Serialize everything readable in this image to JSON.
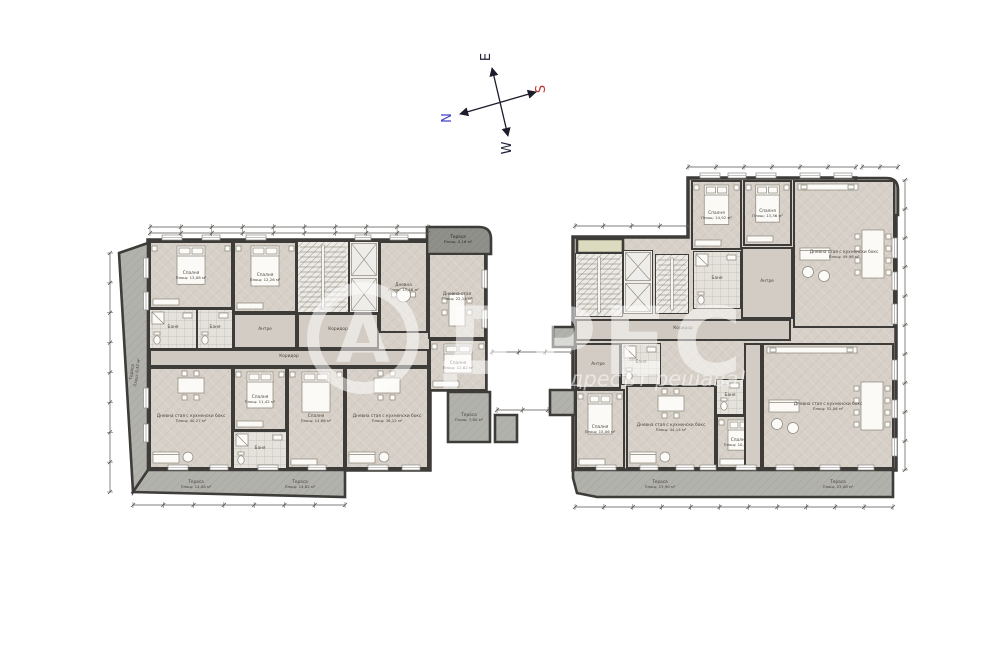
{
  "compass": {
    "n": "N",
    "s": "S",
    "e": "E",
    "w": "W"
  },
  "watermark": {
    "logo_letter": "А",
    "brand_rest": "ДРЕС",
    "slogan": "адресът решава!"
  },
  "colors": {
    "wall": "#3e3c39",
    "floor": "#d6d0c8",
    "terrace": "#b2b2ad",
    "terrace_dark": "#8f908a",
    "terrace_beige": "#dcdabf",
    "label": "#4a453e",
    "north_blue": "#4343c8",
    "south_red": "#c23230"
  },
  "left_block": {
    "rooms": [
      {
        "t": "bedroom",
        "x": 150,
        "y": 242,
        "w": 82,
        "h": 66,
        "name": "Спалня",
        "area": "Площ: 13,08 м²"
      },
      {
        "t": "bedroom",
        "x": 234,
        "y": 242,
        "w": 62,
        "h": 70,
        "name": "Спалня",
        "area": "Площ: 12,26 м²"
      },
      {
        "t": "stairs",
        "x": 298,
        "y": 242,
        "w": 50,
        "h": 70
      },
      {
        "t": "elevator",
        "x": 350,
        "y": 242,
        "w": 28,
        "h": 70
      },
      {
        "t": "living_small",
        "x": 380,
        "y": 242,
        "w": 47,
        "h": 90,
        "name": "Дневна",
        "area": "Площ: 15,48 м²"
      },
      {
        "t": "dining",
        "x": 429,
        "y": 254,
        "w": 56,
        "h": 84,
        "name": "Дневна стая",
        "area": "Площ: 22,14 м²"
      },
      {
        "t": "bath",
        "x": 150,
        "y": 310,
        "w": 46,
        "h": 38,
        "name": "Баня"
      },
      {
        "t": "bath",
        "x": 198,
        "y": 310,
        "w": 34,
        "h": 38,
        "name": "Баня"
      },
      {
        "t": "hall",
        "x": 234,
        "y": 314,
        "w": 62,
        "h": 34,
        "name": "Антре"
      },
      {
        "t": "hall",
        "x": 298,
        "y": 314,
        "w": 80,
        "h": 34,
        "name": "Коридор"
      },
      {
        "t": "corridor",
        "x": 150,
        "y": 350,
        "w": 278,
        "h": 16,
        "name": "Коридор"
      },
      {
        "t": "living_big",
        "x": 150,
        "y": 368,
        "w": 82,
        "h": 100,
        "name": "Дневна стая с кухненски бокс",
        "area": "Площ: 40,27 м²"
      },
      {
        "t": "bedroom",
        "x": 234,
        "y": 368,
        "w": 52,
        "h": 62,
        "name": "Спалня",
        "area": "Площ: 11,42 м²"
      },
      {
        "t": "bath",
        "x": 234,
        "y": 432,
        "w": 52,
        "h": 36,
        "name": "Баня"
      },
      {
        "t": "bedroom",
        "x": 288,
        "y": 368,
        "w": 56,
        "h": 100,
        "name": "Спалня",
        "area": "Площ: 14,86 м²"
      },
      {
        "t": "living_big",
        "x": 346,
        "y": 368,
        "w": 82,
        "h": 100,
        "name": "Дневна стая с кухненски бокс",
        "area": "Площ: 36,12 м²"
      },
      {
        "t": "bedroom",
        "x": 430,
        "y": 340,
        "w": 56,
        "h": 50,
        "name": "Спалня",
        "area": "Площ: 12,62 м²"
      }
    ],
    "terraces": [
      {
        "shape": [
          [
            119,
            253
          ],
          [
            148,
            243
          ],
          [
            148,
            470
          ],
          [
            133,
            492
          ]
        ],
        "kind": "gray",
        "name": "Тераса",
        "area": "Площ: 9,42 м²",
        "lx": 133,
        "ly": 372,
        "rot": -83
      },
      {
        "shape": [
          [
            148,
            470
          ],
          [
            345,
            470
          ],
          [
            345,
            497
          ],
          [
            133,
            492
          ]
        ],
        "kind": "gray",
        "name": "Тераса",
        "area": "Площ: 14,08 м²",
        "lx": 196,
        "ly": 483
      },
      {
        "kind": "label",
        "name": "Тераса",
        "area": "Площ: 14,62 м²",
        "lx": 300,
        "ly": 483
      },
      {
        "rect": [
          427,
          227,
          64,
          27
        ],
        "kind": "dark",
        "round": "tr",
        "name": "Тераса",
        "area": "Площ: 5,16 м²",
        "lx": 458,
        "ly": 238
      },
      {
        "rect": [
          448,
          392,
          42,
          50
        ],
        "kind": "gray",
        "name": "Тераса",
        "area": "Площ: 7,80 м²",
        "lx": 469,
        "ly": 416
      }
    ]
  },
  "right_block": {
    "rooms": [
      {
        "t": "stairs",
        "x": 576,
        "y": 254,
        "w": 46,
        "h": 62
      },
      {
        "t": "elevator",
        "x": 624,
        "y": 251,
        "w": 28,
        "h": 62
      },
      {
        "t": "stairs",
        "x": 656,
        "y": 255,
        "w": 32,
        "h": 58
      },
      {
        "t": "bedroom",
        "x": 692,
        "y": 181,
        "w": 49,
        "h": 68,
        "name": "Спалня",
        "area": "Площ: 14,92 м²"
      },
      {
        "t": "bedroom",
        "x": 744,
        "y": 181,
        "w": 47,
        "h": 64,
        "name": "Спалня",
        "area": "Площ: 13,36 м²"
      },
      {
        "t": "living_huge",
        "x": 794,
        "y": 181,
        "w": 100,
        "h": 146,
        "name": "Дневна стая с кухненски бокс",
        "area": "Площ: 49,98 м²"
      },
      {
        "t": "bath",
        "x": 694,
        "y": 252,
        "w": 46,
        "h": 56,
        "name": "Баня"
      },
      {
        "t": "hall",
        "x": 742,
        "y": 248,
        "w": 50,
        "h": 70,
        "name": "Антре"
      },
      {
        "t": "corridor",
        "x": 576,
        "y": 320,
        "w": 214,
        "h": 20,
        "name": "Коридор"
      },
      {
        "t": "bath",
        "x": 622,
        "y": 344,
        "w": 38,
        "h": 40,
        "name": "Баня"
      },
      {
        "t": "hall",
        "x": 576,
        "y": 344,
        "w": 44,
        "h": 44,
        "name": "Антре"
      },
      {
        "t": "bedroom",
        "x": 576,
        "y": 390,
        "w": 48,
        "h": 78,
        "name": "Спалня",
        "area": "Площ: 15,06 м²"
      },
      {
        "t": "living_big",
        "x": 627,
        "y": 386,
        "w": 88,
        "h": 82,
        "name": "Дневна стая с кухненски бокс",
        "area": "Площ: 44,14 м²"
      },
      {
        "t": "bath",
        "x": 717,
        "y": 380,
        "w": 26,
        "h": 34,
        "name": "Баня"
      },
      {
        "t": "bedroom",
        "x": 717,
        "y": 416,
        "w": 44,
        "h": 52,
        "name": "Спалня",
        "area": "Площ: 10,84 м²"
      },
      {
        "t": "hall",
        "x": 745,
        "y": 344,
        "w": 16,
        "h": 124
      },
      {
        "t": "living_huge",
        "x": 763,
        "y": 344,
        "w": 130,
        "h": 124,
        "name": "Дневна стая с кухненски бокс",
        "area": "Площ: 52,06 м²"
      }
    ],
    "terraces": [
      {
        "rect": [
          856,
          178,
          42,
          37
        ],
        "kind": "dark",
        "round": "tr",
        "name": "Тераса",
        "area": "Площ: 3,93 м²",
        "lx": 877,
        "ly": 194
      },
      {
        "shape": [
          [
            573,
            470
          ],
          [
            893,
            470
          ],
          [
            893,
            497
          ],
          [
            597,
            497
          ],
          [
            577,
            493
          ],
          [
            573,
            478
          ]
        ],
        "kind": "gray",
        "name": "Тераса",
        "area": "Площ: 13,90 м²",
        "lx": 660,
        "ly": 483
      },
      {
        "kind": "label",
        "name": "Тераса",
        "area": "Площ: 23,08 м²",
        "lx": 838,
        "ly": 483
      },
      {
        "rect": [
          577,
          239,
          46,
          14
        ],
        "kind": "beige"
      },
      {
        "rect": [
          550,
          390,
          25,
          25
        ],
        "kind": "gray"
      },
      {
        "rect": [
          495,
          415,
          22,
          27
        ],
        "kind": "gray"
      },
      {
        "rect": [
          553,
          327,
          22,
          20
        ],
        "kind": "gray"
      }
    ]
  }
}
